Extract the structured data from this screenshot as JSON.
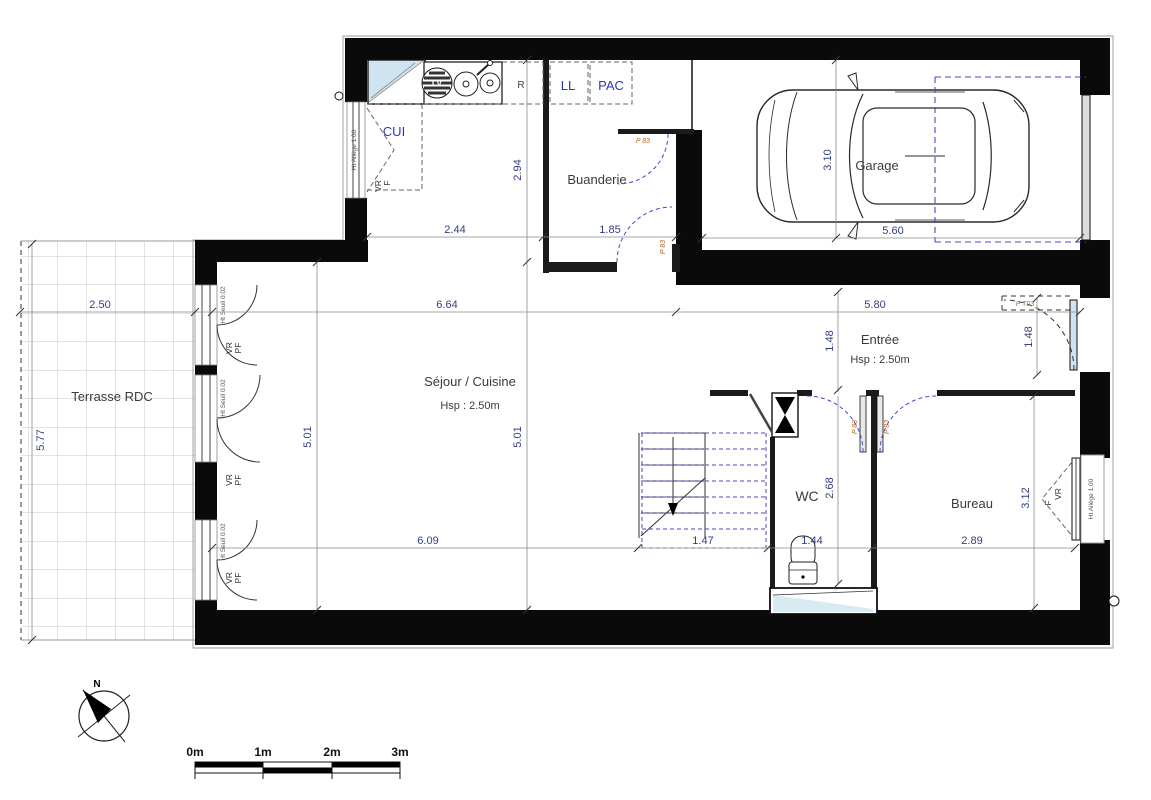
{
  "rooms": {
    "terrasse": {
      "label": "Terrasse RDC",
      "dim_w": "2.50",
      "dim_h": "5.77"
    },
    "sejour": {
      "label": "Séjour / Cuisine",
      "hsp": "Hsp : 2.50m",
      "dim_top": "6.64",
      "dim_left": "5.01",
      "dim_mid": "5.01",
      "dim_bottom": "6.09",
      "dim_kitchen_w": "2.44",
      "dim_kitchen_h": "2.94"
    },
    "buanderie": {
      "label": "Buanderie",
      "dim_w": "1.85"
    },
    "garage": {
      "label": "Garage",
      "dim_h": "3.10",
      "dim_w": "5.60"
    },
    "entree": {
      "label": "Entrée",
      "hsp": "Hsp : 2.50m",
      "dim_w": "5.80",
      "dim_left": "1.48",
      "dim_door": "1.48"
    },
    "wc": {
      "label": "WC",
      "dim_h": "2.68",
      "dim_w": "1.44"
    },
    "bureau": {
      "label": "Bureau",
      "dim_h": "3.12",
      "dim_w": "2.89"
    },
    "stair": {
      "dim_w": "1.47"
    }
  },
  "kitchen": {
    "cui": "CUI",
    "lv": "LV",
    "fridge": "R",
    "ll": "LL",
    "pac": "PAC",
    "shutter_vr": "VR",
    "shutter_f": "F",
    "allege": "Ht Allège 1.00"
  },
  "windows": {
    "vr": "VR",
    "pf": "PF",
    "seuil": "Ht Seuil 0.02",
    "bureau_vr": "VR",
    "bureau_f": "F",
    "bureau_allege": "Ht Allège 1.00"
  },
  "doors": {
    "p83": "P 83",
    "entry": "P T03"
  },
  "compass": {
    "north": "N"
  },
  "scalebar": {
    "m0": "0m",
    "m1": "1m",
    "m2": "2m",
    "m3": "3m"
  },
  "colors": {
    "wall": "#0a0a0a",
    "dim_text": "#333f7d",
    "blue_label": "#2a38b5",
    "door_label": "#b16a2a",
    "swing_arc": "#4747c8",
    "glass": "#cfe4f0"
  }
}
